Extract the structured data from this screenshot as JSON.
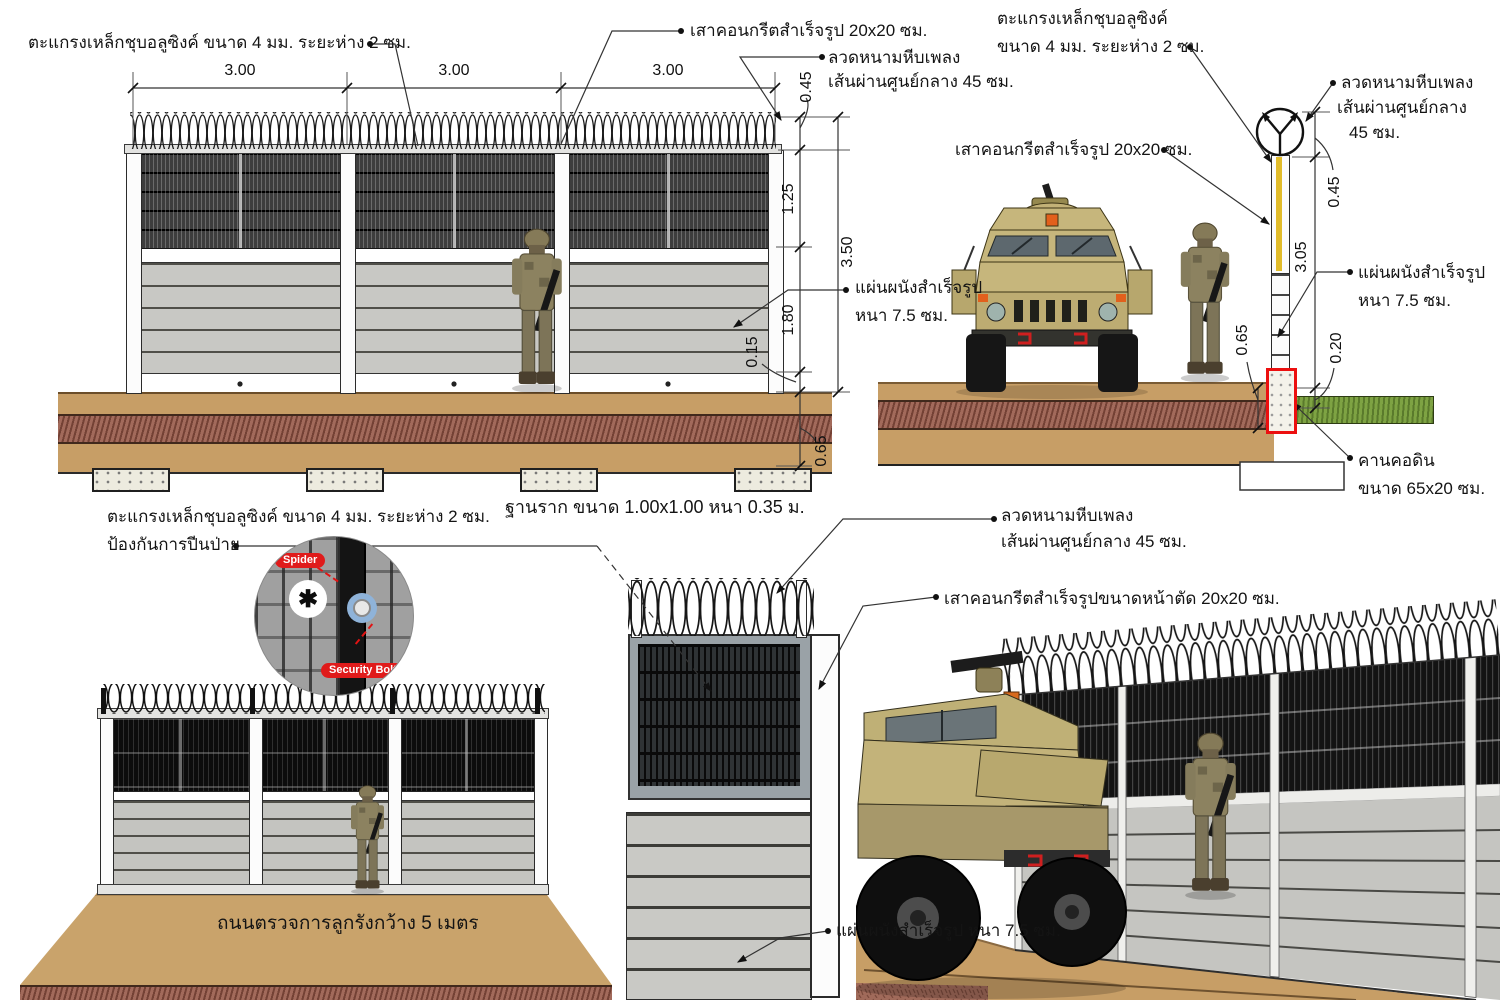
{
  "drawing": {
    "annotations": {
      "mesh_spec_inline": "ตะแกรงเหล็กชุบอลูซิงค์ ขนาด 4 มม. ระยะห่าง 2 ซม.",
      "mesh_spec_line1": "ตะแกรงเหล็กชุบอลูซิงค์",
      "mesh_spec_line2": "ขนาด 4 มม. ระยะห่าง 2 ซม.",
      "anti_climb_line2": "ป้องกันการปีนป่าย",
      "precast_post": "เสาคอนกรีตสำเร็จรูป 20x20 ซม.",
      "precast_post_section": "เสาคอนกรีตสำเร็จรูปขนาดหน้าตัด 20x20 ซม.",
      "concertina_line1": "ลวดหนามหีบเพลง",
      "concertina_line2": "เส้นผ่านศูนย์กลาง 45 ซม.",
      "concertina_line2a": "เส้นผ่านศูนย์กลาง",
      "concertina_line2b": "45 ซม.",
      "wall_panel_line1": "แผ่นผนังสำเร็จรูป",
      "wall_panel_line2": "หนา 7.5 ซม.",
      "wall_panel_inline": "แผ่นผนังสำเร็จรูป หนา 7.5 ซม.",
      "footing_caption": "ฐานราก ขนาด 1.00x1.00 หนา 0.35 ม.",
      "ground_beam_line1": "คานคอดิน",
      "ground_beam_line2": "ขนาด 65x20 ซม.",
      "road_caption": "ถนนตรวจการลูกรังกว้าง 5 เมตร",
      "spider_badge": "Spider",
      "security_bolt_badge": "Security Bolt"
    },
    "dimensions_front": {
      "bay1": "3.00",
      "bay2": "3.00",
      "bay3": "3.00",
      "coil": "0.45",
      "mesh": "1.25",
      "total": "3.50",
      "panel": "1.80",
      "plank": "0.15",
      "foundation": "0.65"
    },
    "dimensions_section": {
      "coil": "0.45",
      "post": "3.05",
      "embed": "0.20",
      "foundation": "0.65"
    },
    "colors": {
      "highlight_red": "#ec0f0f",
      "badge_red": "#e01b1b",
      "post_marker_yellow": "#e2bc2a",
      "ground_tan": "#c79e66",
      "gravel_red_brown": "#a26a5b",
      "grass_green": "#7ea343",
      "vehicle_tan": "#c6b67c",
      "bolt_circle_blue": "#8fb3d9"
    }
  }
}
